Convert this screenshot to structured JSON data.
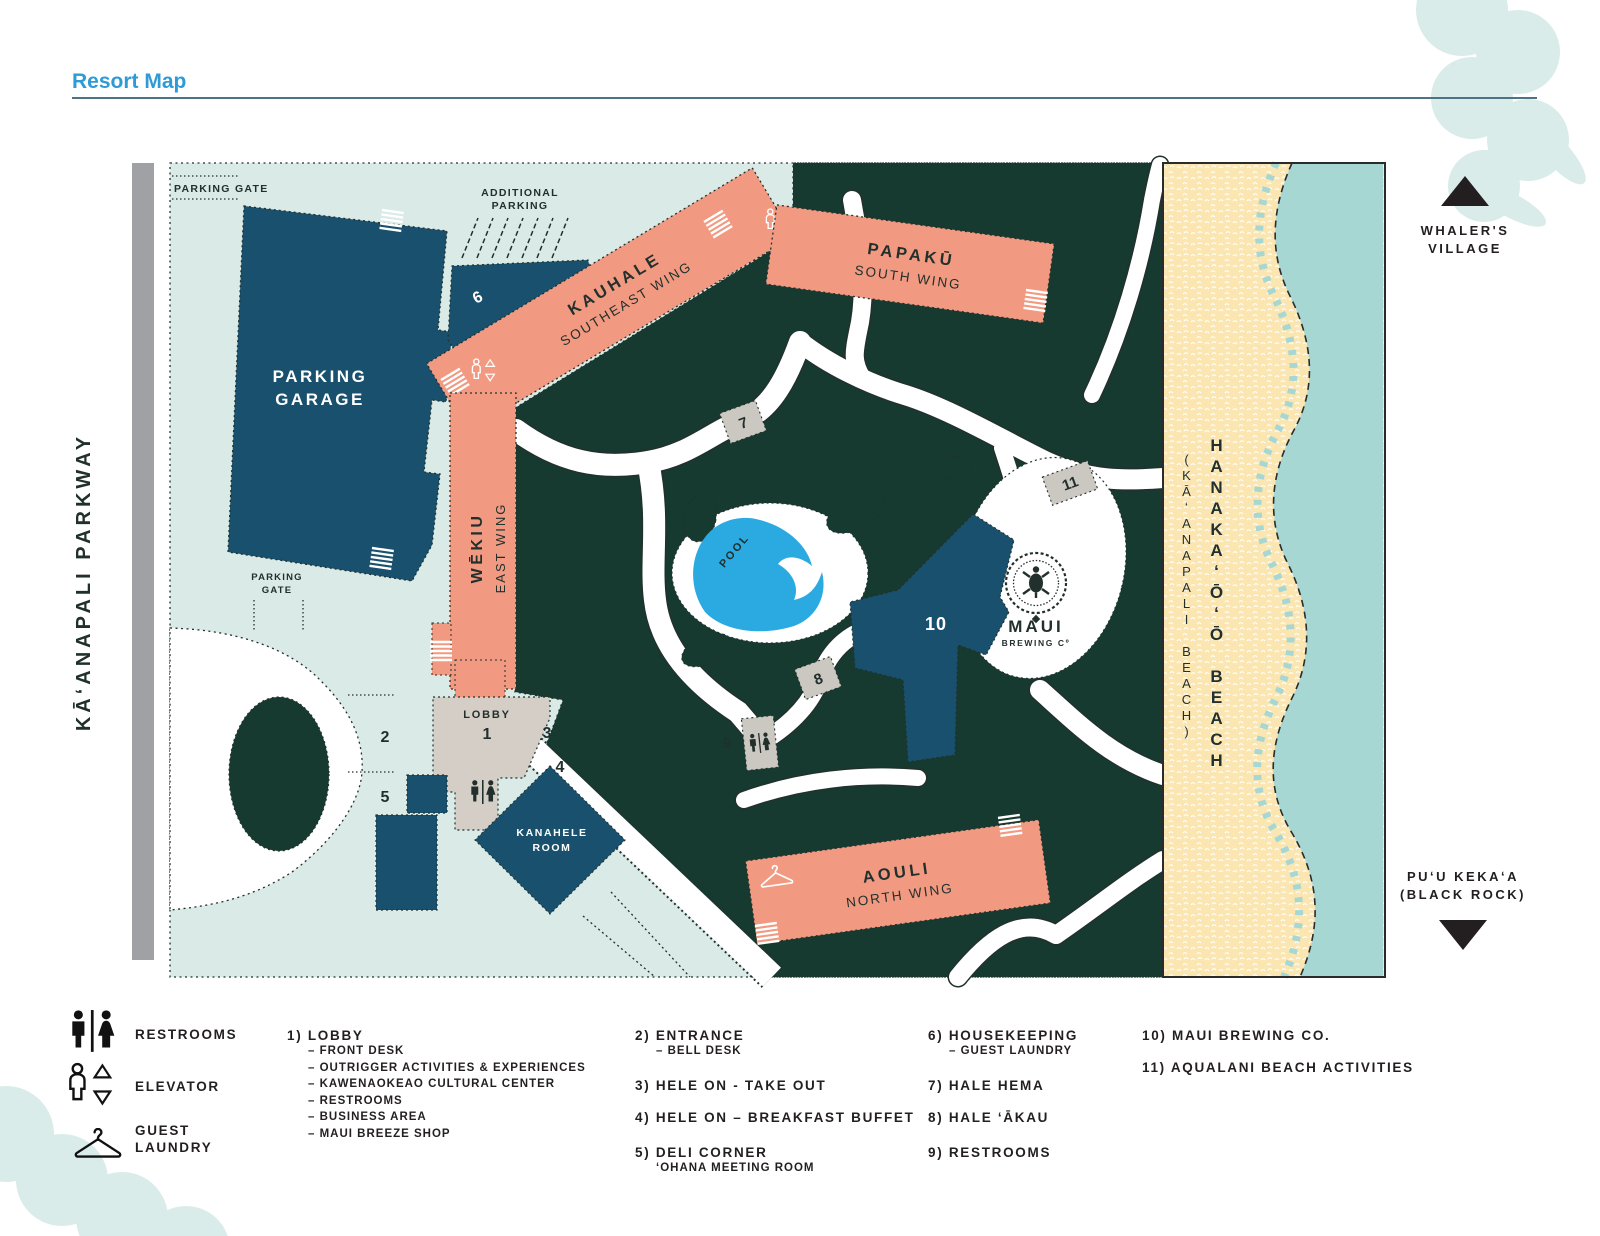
{
  "page": {
    "title": "Resort Map"
  },
  "map": {
    "parkway": "KĀʻANAPALI PARKWAY",
    "parking_gate": "PARKING GATE",
    "parking_gate2_l1": "PARKING",
    "parking_gate2_l2": "GATE",
    "additional_parking_l1": "ADDITIONAL",
    "additional_parking_l2": "PARKING",
    "garage_l1": "PARKING",
    "garage_l2": "GARAGE",
    "housekeeping": "HOUSEKEEPING",
    "kauhale": "KAUHALE",
    "kauhale_sub": "SOUTHEAST WING",
    "papaku": "PAPAKŪ",
    "papaku_sub": "SOUTH WING",
    "wekiu": "WĒKIU",
    "wekiu_sub": "EAST WING",
    "lobby": "LOBBY",
    "kanahele_l1": "KANAHELE",
    "kanahele_l2": "ROOM",
    "pool": "POOL",
    "aouli": "AOULI",
    "aouli_sub": "NORTH WING",
    "brewing_l1": "MAUI",
    "brewing_l2": "BREWING Cº",
    "n1": "1",
    "n2": "2",
    "n3": "3",
    "n4": "4",
    "n5": "5",
    "n6": "6",
    "n7": "7",
    "n8": "8",
    "n9": "9",
    "n10": "10",
    "n11": "11",
    "beach_l1": "HANAKAʻŌʻŌ BEACH",
    "beach_l2": "(KĀʻANAPALI BEACH)",
    "whalers_l1": "WHALER'S",
    "whalers_l2": "VILLAGE",
    "puu_l1": "PUʻU KEKAʻA",
    "puu_l2": "(BLACK ROCK)"
  },
  "legend": {
    "icons": [
      {
        "label_l1": "RESTROOMS",
        "label_l2": ""
      },
      {
        "label_l1": "ELEVATOR",
        "label_l2": ""
      },
      {
        "label_l1": "GUEST",
        "label_l2": "LAUNDRY"
      }
    ],
    "items": [
      {
        "title": "1) LOBBY",
        "subs": [
          "– FRONT DESK",
          "– OUTRIGGER ACTIVITIES & EXPERIENCES",
          "– KAWENAOKEAO CULTURAL CENTER",
          "– RESTROOMS",
          "– BUSINESS AREA",
          "– MAUI BREEZE SHOP"
        ]
      },
      {
        "title": "2) ENTRANCE",
        "subs": [
          "– BELL DESK"
        ]
      },
      {
        "title": "3) HELE ON - TAKE OUT",
        "subs": []
      },
      {
        "title": "4) HELE ON – BREAKFAST BUFFET",
        "subs": []
      },
      {
        "title": "5) DELI CORNER",
        "subs": [
          "ʻOHANA MEETING ROOM"
        ]
      },
      {
        "title": "6) HOUSEKEEPING",
        "subs": [
          "– GUEST LAUNDRY"
        ]
      },
      {
        "title": "7) HALE HEMA",
        "subs": []
      },
      {
        "title": "8) HALE ʻĀKAU",
        "subs": []
      },
      {
        "title": "9) RESTROOMS",
        "subs": []
      },
      {
        "title": "10) MAUI BREWING CO.",
        "subs": []
      },
      {
        "title": "11) AQUALANI BEACH ACTIVITIES",
        "subs": []
      }
    ]
  },
  "colors": {
    "title_blue": "#2E9BD6",
    "mint": "#D9EAE7",
    "dark_green": "#163A30",
    "salmon": "#F19A81",
    "navy": "#18506E",
    "gray_building": "#D5CEC6",
    "marker_gray": "#CBC7C1",
    "road_gray": "#9FA1A4",
    "sand": "#FBE6B1",
    "water": "#A7D7D3",
    "pool_blue": "#2BA9E1",
    "ink": "#22302D"
  }
}
